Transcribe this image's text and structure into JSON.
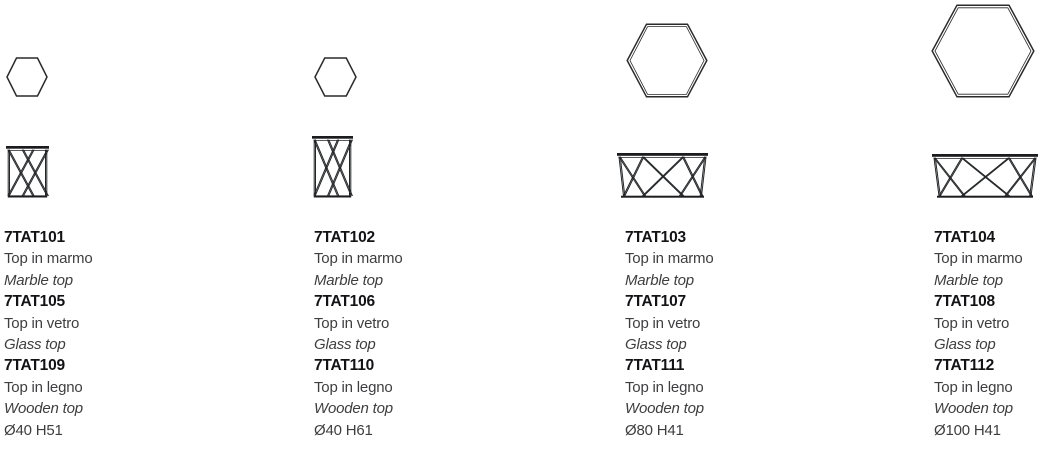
{
  "colors": {
    "background": "#ffffff",
    "line_color": "#232527",
    "code_text": "#131316",
    "body_text": "#3e3e40"
  },
  "products": [
    {
      "top_view_icon": "hexagon-top-view",
      "front_view_icon": "x-frame-lattice-front-view",
      "dimensions": "Ø40 H51",
      "variants": [
        {
          "code": "7TAT101",
          "desc_it": "Top in marmo",
          "desc_en": "Marble top"
        },
        {
          "code": "7TAT105",
          "desc_it": "Top in vetro",
          "desc_en": "Glass top"
        },
        {
          "code": "7TAT109",
          "desc_it": "Top in legno",
          "desc_en": "Wooden top"
        }
      ]
    },
    {
      "top_view_icon": "hexagon-top-view",
      "front_view_icon": "x-frame-lattice-front-view",
      "dimensions": "Ø40 H61",
      "variants": [
        {
          "code": "7TAT102",
          "desc_it": "Top in marmo",
          "desc_en": "Marble top"
        },
        {
          "code": "7TAT106",
          "desc_it": "Top in vetro",
          "desc_en": "Glass top"
        },
        {
          "code": "7TAT110",
          "desc_it": "Top in legno",
          "desc_en": "Wooden top"
        }
      ]
    },
    {
      "top_view_icon": "hexagon-top-view",
      "front_view_icon": "x-frame-truss-front-view",
      "dimensions": "Ø80 H41",
      "variants": [
        {
          "code": "7TAT103",
          "desc_it": "Top in marmo",
          "desc_en": "Marble top"
        },
        {
          "code": "7TAT107",
          "desc_it": "Top in vetro",
          "desc_en": "Glass top"
        },
        {
          "code": "7TAT111",
          "desc_it": "Top in legno",
          "desc_en": "Wooden top"
        }
      ]
    },
    {
      "top_view_icon": "hexagon-top-view",
      "front_view_icon": "x-frame-truss-front-view",
      "dimensions": "Ø100 H41",
      "variants": [
        {
          "code": "7TAT104",
          "desc_it": "Top in marmo",
          "desc_en": "Marble top"
        },
        {
          "code": "7TAT108",
          "desc_it": "Top in vetro",
          "desc_en": "Glass top"
        },
        {
          "code": "7TAT112",
          "desc_it": "Top in legno",
          "desc_en": "Wooden top"
        }
      ]
    }
  ]
}
